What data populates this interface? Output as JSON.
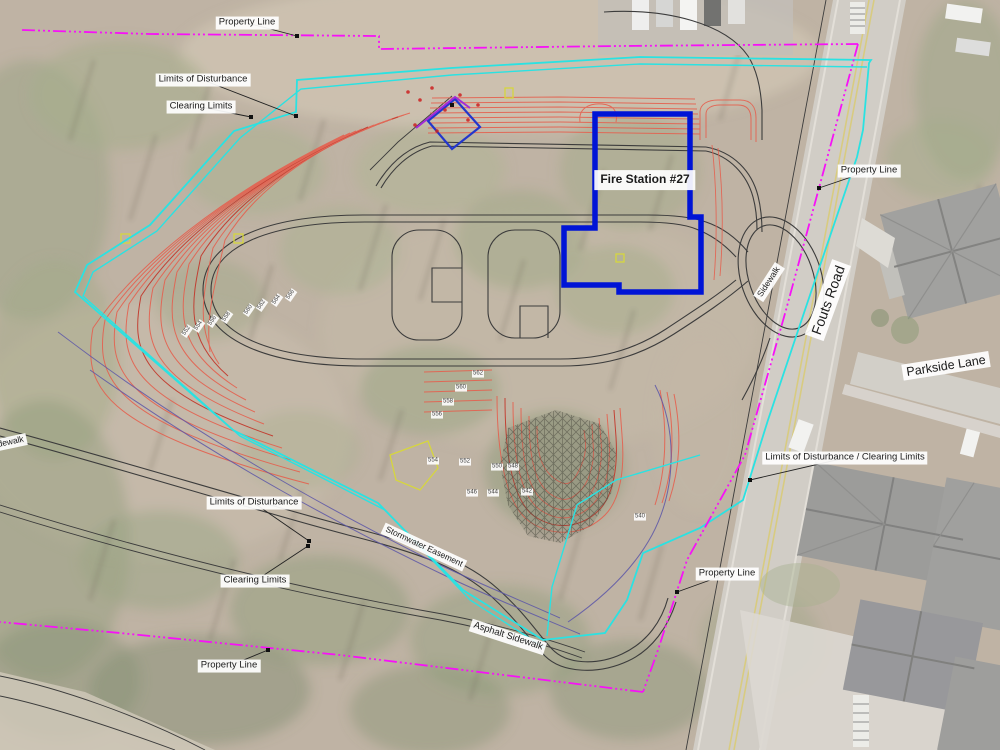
{
  "building": {
    "label": "Fire Station #27"
  },
  "roads": {
    "main": "Fouts Road",
    "side": "Parkside Lane"
  },
  "colors": {
    "property_line": "#f711f7",
    "limits_of_disturbance": "#2ae2e2",
    "contour": "#e05a4c",
    "easement": "#5b55a8",
    "building_outline": "#0014d6",
    "existing_linework": "#3c3c3c"
  },
  "annotations": [
    {
      "name": "label-property-line-top",
      "text": "Property Line",
      "x": 247,
      "y": 23,
      "size": "m",
      "leader": {
        "x2": 297,
        "y2": 36
      }
    },
    {
      "name": "label-limits-of-disturbance-nw",
      "text": "Limits of Disturbance",
      "x": 203,
      "y": 80,
      "size": "m",
      "leader": {
        "x2": 296,
        "y2": 116
      }
    },
    {
      "name": "label-clearing-limits-nw",
      "text": "Clearing Limits",
      "x": 201,
      "y": 107,
      "size": "m",
      "leader": {
        "x2": 251,
        "y2": 117
      }
    },
    {
      "name": "label-fire-station",
      "text": "Fire Station #27",
      "x": 645,
      "y": 180,
      "size": "title"
    },
    {
      "name": "label-property-line-e",
      "text": "Property Line",
      "x": 869,
      "y": 171,
      "size": "m",
      "leader": {
        "x2": 819,
        "y2": 188
      }
    },
    {
      "name": "label-sidewalk-e",
      "text": "Sidewalk",
      "x": 769,
      "y": 282,
      "size": "s",
      "rot": -57
    },
    {
      "name": "label-fouts-road",
      "text": "Fouts Road",
      "x": 828,
      "y": 300,
      "size": "road",
      "rot": -70
    },
    {
      "name": "label-parkside-lane",
      "text": "Parkside Lane",
      "x": 946,
      "y": 366,
      "size": "road2",
      "rot": -9
    },
    {
      "name": "label-lod-clearing-e",
      "text": "Limits of Disturbance / Clearing Limits",
      "x": 845,
      "y": 458,
      "size": "m",
      "leader": {
        "x2": 750,
        "y2": 480
      }
    },
    {
      "name": "label-property-line-s",
      "text": "Property Line",
      "x": 727,
      "y": 574,
      "size": "m",
      "leader": {
        "x2": 677,
        "y2": 592
      }
    },
    {
      "name": "label-limits-of-disturbance-s",
      "text": "Limits of Disturbance",
      "x": 254,
      "y": 503,
      "size": "m",
      "leader": {
        "x2": 309,
        "y2": 541
      }
    },
    {
      "name": "label-clearing-limits-s",
      "text": "Clearing Limits",
      "x": 255,
      "y": 581,
      "size": "m",
      "leader": {
        "x2": 308,
        "y2": 546
      }
    },
    {
      "name": "label-stormwater-easement",
      "text": "Stormwater Easement",
      "x": 424,
      "y": 547,
      "size": "s",
      "rot": 25
    },
    {
      "name": "label-asphalt-sidewalk",
      "text": "Asphalt Sidewalk",
      "x": 508,
      "y": 637,
      "size": "m",
      "rot": 18
    },
    {
      "name": "label-property-line-sw",
      "text": "Property Line",
      "x": 229,
      "y": 666,
      "size": "m",
      "leader": {
        "x2": 268,
        "y2": 650
      }
    },
    {
      "name": "label-sidewalk-w",
      "text": "Sidewalk",
      "x": 7,
      "y": 443,
      "size": "s",
      "rot": -12
    }
  ],
  "contour_labels": [
    {
      "text": "552",
      "x": 187,
      "y": 331,
      "rot": -55
    },
    {
      "text": "554",
      "x": 199,
      "y": 326,
      "rot": -55
    },
    {
      "text": "556",
      "x": 213,
      "y": 321,
      "rot": -55
    },
    {
      "text": "558",
      "x": 227,
      "y": 317,
      "rot": -55
    },
    {
      "text": "560",
      "x": 249,
      "y": 310,
      "rot": -55
    },
    {
      "text": "562",
      "x": 262,
      "y": 305,
      "rot": -55
    },
    {
      "text": "564",
      "x": 277,
      "y": 300,
      "rot": -55
    },
    {
      "text": "566",
      "x": 291,
      "y": 295,
      "rot": -55
    },
    {
      "text": "562",
      "x": 478,
      "y": 374,
      "rot": 0
    },
    {
      "text": "560",
      "x": 461,
      "y": 388,
      "rot": 0
    },
    {
      "text": "558",
      "x": 448,
      "y": 402,
      "rot": 0
    },
    {
      "text": "556",
      "x": 437,
      "y": 415,
      "rot": 0
    },
    {
      "text": "554",
      "x": 433,
      "y": 461,
      "rot": 0
    },
    {
      "text": "552",
      "x": 465,
      "y": 462,
      "rot": 0
    },
    {
      "text": "550",
      "x": 497,
      "y": 467,
      "rot": 0
    },
    {
      "text": "548",
      "x": 513,
      "y": 467,
      "rot": 0
    },
    {
      "text": "546",
      "x": 472,
      "y": 493,
      "rot": 0
    },
    {
      "text": "544",
      "x": 493,
      "y": 493,
      "rot": 0
    },
    {
      "text": "542",
      "x": 527,
      "y": 492,
      "rot": 0
    },
    {
      "text": "540",
      "x": 640,
      "y": 517,
      "rot": 0
    }
  ]
}
